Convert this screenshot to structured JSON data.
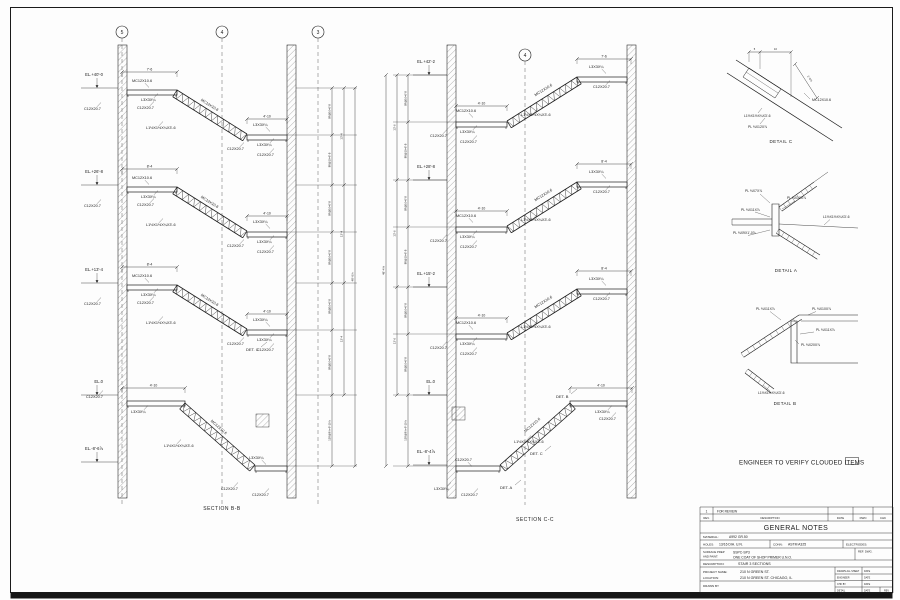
{
  "note": {
    "text": "ENGINEER TO VERIFY CLOUDED ITEMS"
  },
  "members": {
    "stringer": "MC12X10.6",
    "channel": "C12X20.7",
    "landing_angle": "L3X3X¼",
    "tread": "L1½X1½X¼X3'-6"
  },
  "sections": [
    {
      "name": "SECTION  B-B",
      "grids": [
        "5",
        "4",
        "3"
      ],
      "floors": [
        {
          "el": "EL.+40'-0",
          "dim": "7'-6"
        },
        {
          "el": "EL.+26'-8",
          "dim": "8'-4"
        },
        {
          "el": "EL.+13'-4",
          "dim": "8'-4"
        },
        {
          "el": "EL.0",
          "dim": "4'-10"
        }
      ],
      "base_el": "EL.-8'-6⅞",
      "dims": {
        "landing": "4'-10",
        "riser": "8R@10=6'-8",
        "floor": "13'-4",
        "bottom": "12R@9⅞=9'-10⅞",
        "total": "48'-6⅞"
      },
      "det_refs": [
        "DET. C"
      ]
    },
    {
      "name": "SECTION  C-C",
      "grids": [
        "4"
      ],
      "floors": [
        {
          "el": "EL.+42'-2",
          "dim": "7'-6"
        },
        {
          "el": "EL.+28'-8",
          "dim": "8'-4"
        },
        {
          "el": "EL.+15'-2",
          "dim": "8'-4"
        },
        {
          "el": "EL.0",
          "dim": "4'-10"
        }
      ],
      "base_el": "EL.-8'-4⅞",
      "dims": {
        "landing": "4'-10",
        "riser": "8R@10=6'-8",
        "floor": "13'-6",
        "bottom": "12R@9⅞=9'-10⅞",
        "total": "48'-4⅞"
      },
      "det_refs": [
        "DET. B",
        "DET. C",
        "DET. A"
      ]
    }
  ],
  "details": [
    {
      "name": "DETAIL  C",
      "dims": [
        "5",
        "10"
      ],
      "vdim": "1'-0⅞",
      "labels": [
        "MC12X10.6",
        "L1½X1½X¼X3'-6",
        "PL ⅜X12X⅞"
      ]
    },
    {
      "name": "DETAIL  A",
      "labels": [
        "PL ⅜X7X⅞",
        "PL ⅜X10X⅞",
        "PL ⅜X11X⅞",
        "L1½X1½X¼X3'-6",
        "PL ⅜X9X1'-0⅞"
      ]
    },
    {
      "name": "DETAIL  B",
      "labels": [
        "PL ⅜X11X⅞",
        "PL ⅜X10X⅞",
        "PL ⅜X11X⅞",
        "PL ⅜X20X⅞",
        "L1½X1½X¼X3'-6"
      ]
    }
  ],
  "title_block": {
    "rev_no": "1",
    "rev_desc": "FOR REVIEW",
    "col_rev": "REV.",
    "col_desc": "DESCRIPTION",
    "col_date": "DATE",
    "col_dwn": "DWN",
    "col_chk": "CHK",
    "title": "GENERAL NOTES",
    "material_label": "MATERIAL:",
    "material": "A992 GR.50",
    "holes_label": "HOLES:",
    "holes": "13/16 DIA. U.N.",
    "conn_label": "CONN:",
    "conn": "ASTM A325",
    "electrodes_label": "ELECTRODES:",
    "surface_label1": "SURFACE PREP",
    "surface_label2": "AND PAINT:",
    "surface_value1": "SSPC-SP3",
    "surface_value2": "ONE COAT OF SHOP PRIMER U.N.O.",
    "ref_dwg_label": "REF. DWG.",
    "description_label": "DESCRIPTION:",
    "description": "STAIR 3 SECTIONS",
    "project_label": "PROJECT NAME:",
    "project": "210 N GREEN ST.",
    "location_label": "LOCATION:",
    "location": "210 N GREEN ST. CHICAGO, IL",
    "drawn_by_label": "DRAWN BY",
    "sign_rows": [
      [
        "DRAWN ALL SHEET",
        "DATE"
      ],
      [
        "ENGINEER",
        "DATE"
      ],
      [
        "CHK BY",
        "DATE"
      ],
      [
        "DETAIL",
        "DATE"
      ]
    ],
    "rev_cell": "REV"
  }
}
